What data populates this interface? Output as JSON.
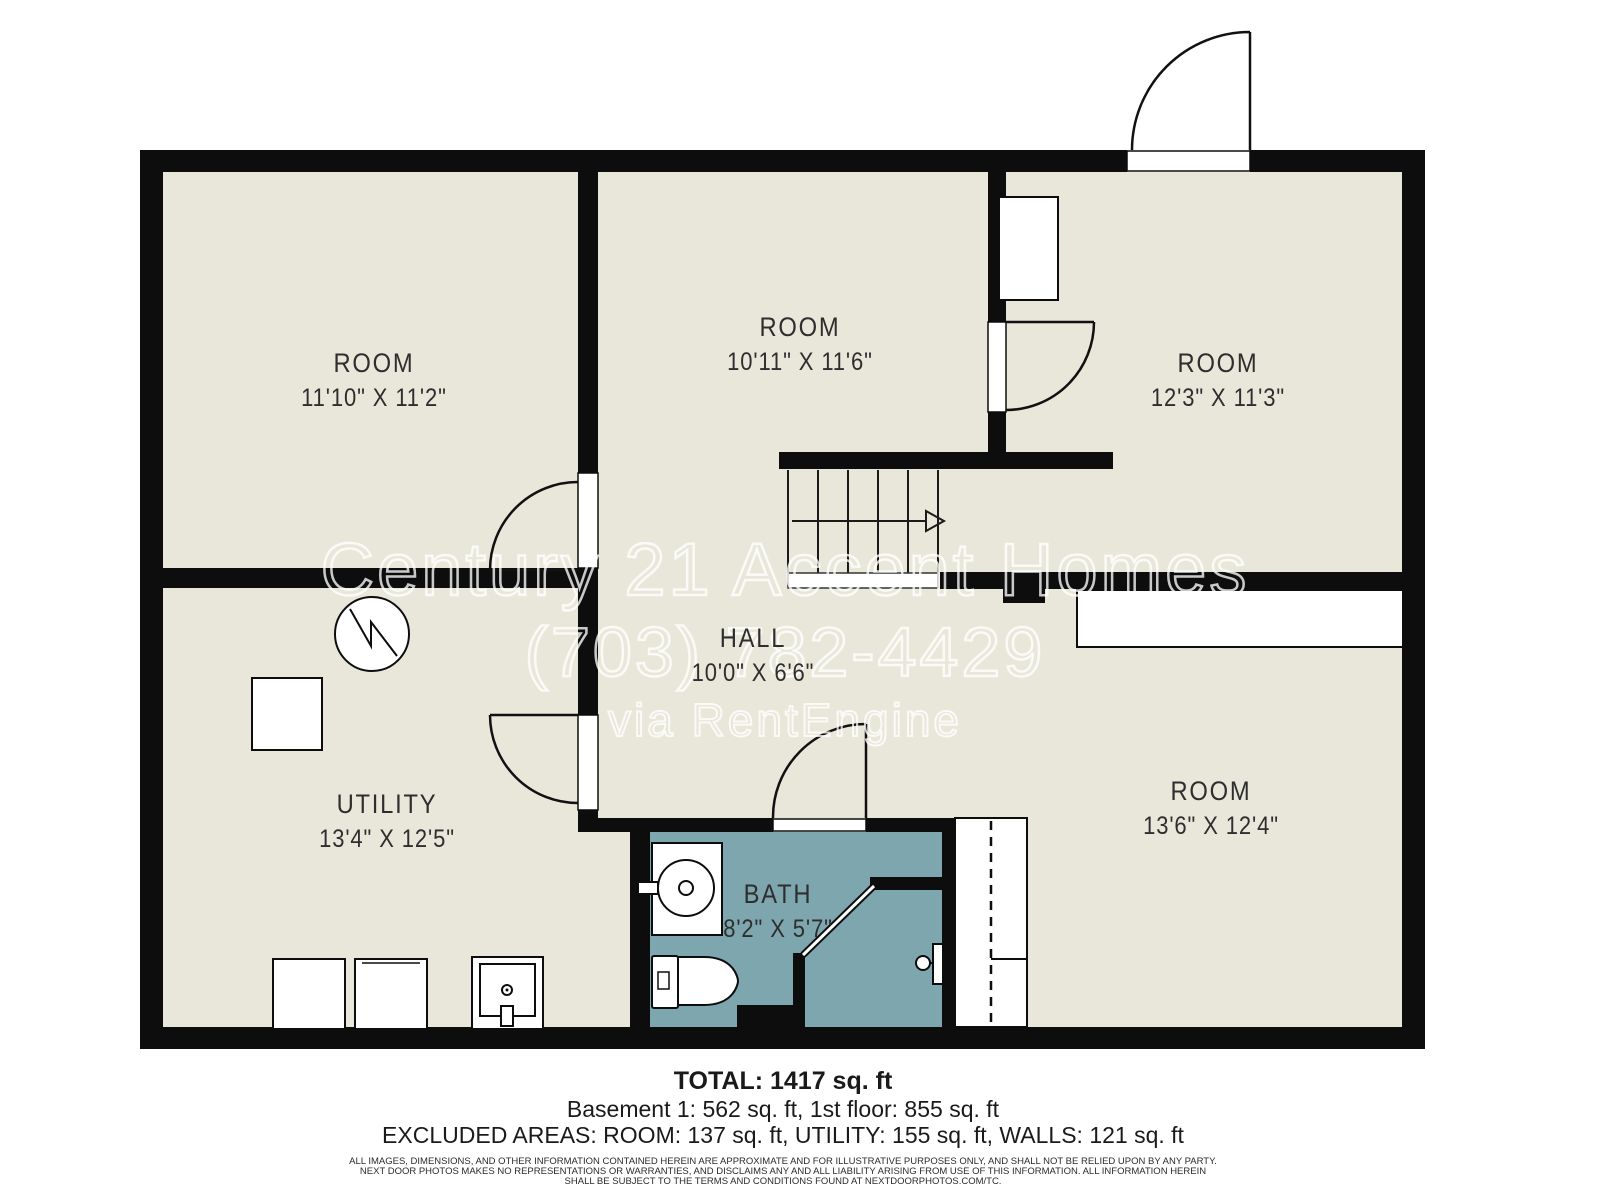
{
  "plan": {
    "rooms": [
      {
        "id": "room-top-left",
        "name": "ROOM",
        "dims": "11'10\" X 11'2\""
      },
      {
        "id": "room-top-middle",
        "name": "ROOM",
        "dims": "10'11\" X 11'6\""
      },
      {
        "id": "room-top-right",
        "name": "ROOM",
        "dims": "12'3\" X 11'3\""
      },
      {
        "id": "hall",
        "name": "HALL",
        "dims": "10'0\" X 6'6\""
      },
      {
        "id": "utility",
        "name": "UTILITY",
        "dims": "13'4\" X 12'5\""
      },
      {
        "id": "bath",
        "name": "BATH",
        "dims": "8'2\" X 5'7\""
      },
      {
        "id": "room-bottom-right",
        "name": "ROOM",
        "dims": "13'6\" X 12'4\""
      }
    ],
    "fixtures": [
      "water-heater",
      "furnace",
      "washer",
      "dryer",
      "laundry-sink",
      "vanity-sink",
      "toilet",
      "shower-door",
      "shower-head",
      "bifold-closet",
      "closet",
      "built-in",
      "stairs"
    ]
  },
  "watermark": {
    "line1": "Century 21 Accent Homes",
    "line2": "(703) 782-4429",
    "line3": "via RentEngine"
  },
  "summary": {
    "total": "TOTAL: 1417 sq. ft",
    "floors": "Basement 1: 562 sq. ft, 1st floor: 855 sq. ft",
    "excluded": "EXCLUDED AREAS: ROOM: 137 sq. ft, UTILITY: 155 sq. ft, WALLS: 121 sq. ft"
  },
  "disclaimer": {
    "line1": "ALL IMAGES, DIMENSIONS, AND OTHER INFORMATION CONTAINED HEREIN ARE APPROXIMATE AND FOR ILLUSTRATIVE PURPOSES ONLY, AND SHALL NOT BE RELIED UPON BY ANY PARTY.",
    "line2": "NEXT DOOR PHOTOS MAKES NO REPRESENTATIONS OR WARRANTIES, AND DISCLAIMS ANY AND ALL LIABILITY ARISING FROM USE OF THIS INFORMATION. ALL INFORMATION HEREIN",
    "line3": "SHALL BE SUBJECT TO THE TERMS AND CONDITIONS FOUND AT NEXTDOORPHOTOS.COM/TC."
  },
  "colors": {
    "wall": "#0d0d0d",
    "floor": "#e9e6da",
    "bath": "#7da6ae",
    "paper": "#ffffff",
    "label": "#2e2e2e"
  }
}
